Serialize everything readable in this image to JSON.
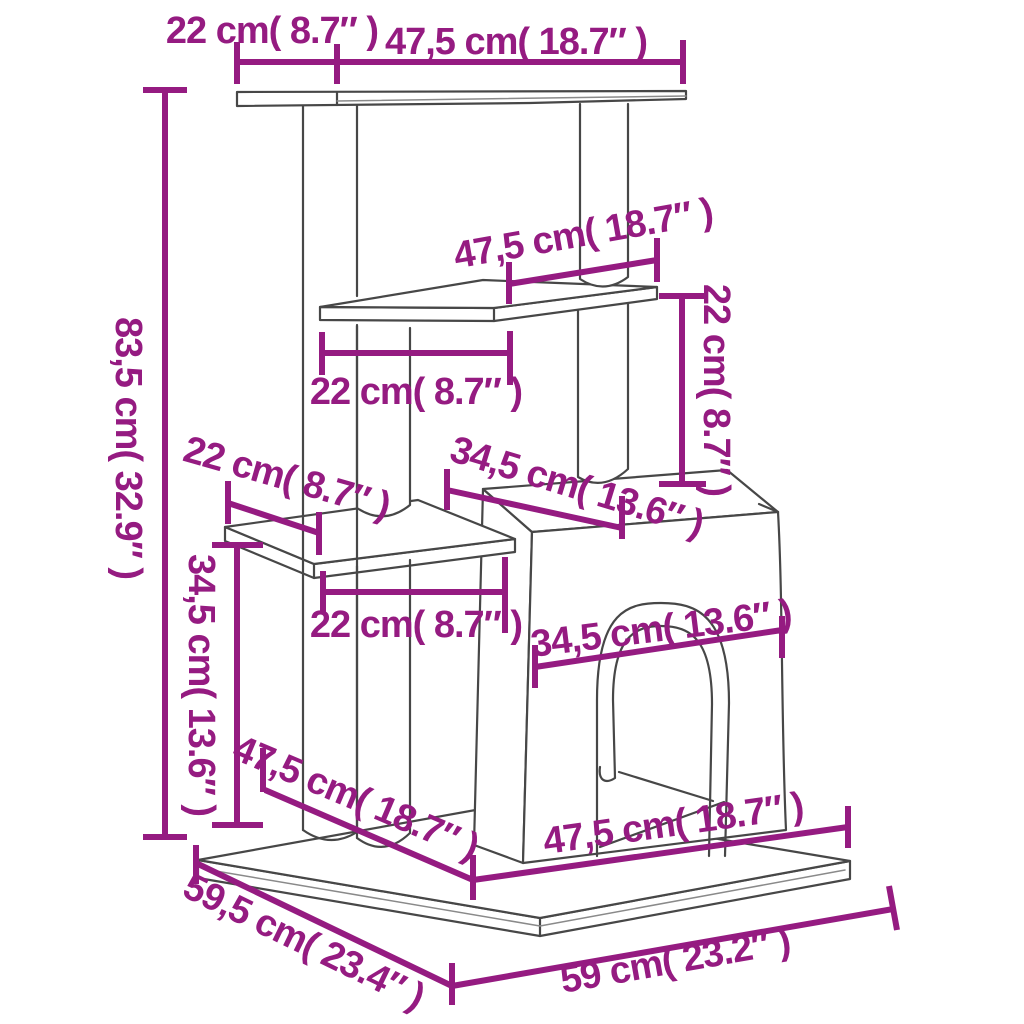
{
  "figure": {
    "type": "product-dimension-diagram",
    "subject": "cat tree with scratching posts, platforms and cat house",
    "background_color": "#ffffff",
    "outline_color": "#474747",
    "accent_color": "#951b81"
  },
  "dims": {
    "top_depth": {
      "label": "22 cm( 8.7″ )"
    },
    "top_width": {
      "label": "47,5 cm( 18.7″ )"
    },
    "total_height": {
      "label": "83,5 cm( 32.9″ )"
    },
    "mid_platform_width": {
      "label": "47,5 cm( 18.7″ )"
    },
    "mid_platform_depth": {
      "label": "22 cm( 8.7″ )"
    },
    "upper_gap_height": {
      "label": "22 cm( 8.7″ )"
    },
    "small_platform_depth": {
      "label": "22 cm( 8.7″ )"
    },
    "roof_depth": {
      "label": "34,5 cm( 13.6″ )"
    },
    "lower_height": {
      "label": "34,5 cm( 13.6″ )"
    },
    "small_platform_width": {
      "label": "22 cm( 8.7″ )"
    },
    "door_width": {
      "label": "34,5 cm( 13.6″ )"
    },
    "base_span_diагonal": {
      "label": "47,5 cm( 18.7″ )"
    },
    "house_bottom_width": {
      "label": "47,5 cm( 18.7″ )"
    },
    "base_depth": {
      "label": "59,5 cm( 23.4″ )"
    },
    "base_width": {
      "label": "59 cm( 23.2″ )"
    }
  }
}
